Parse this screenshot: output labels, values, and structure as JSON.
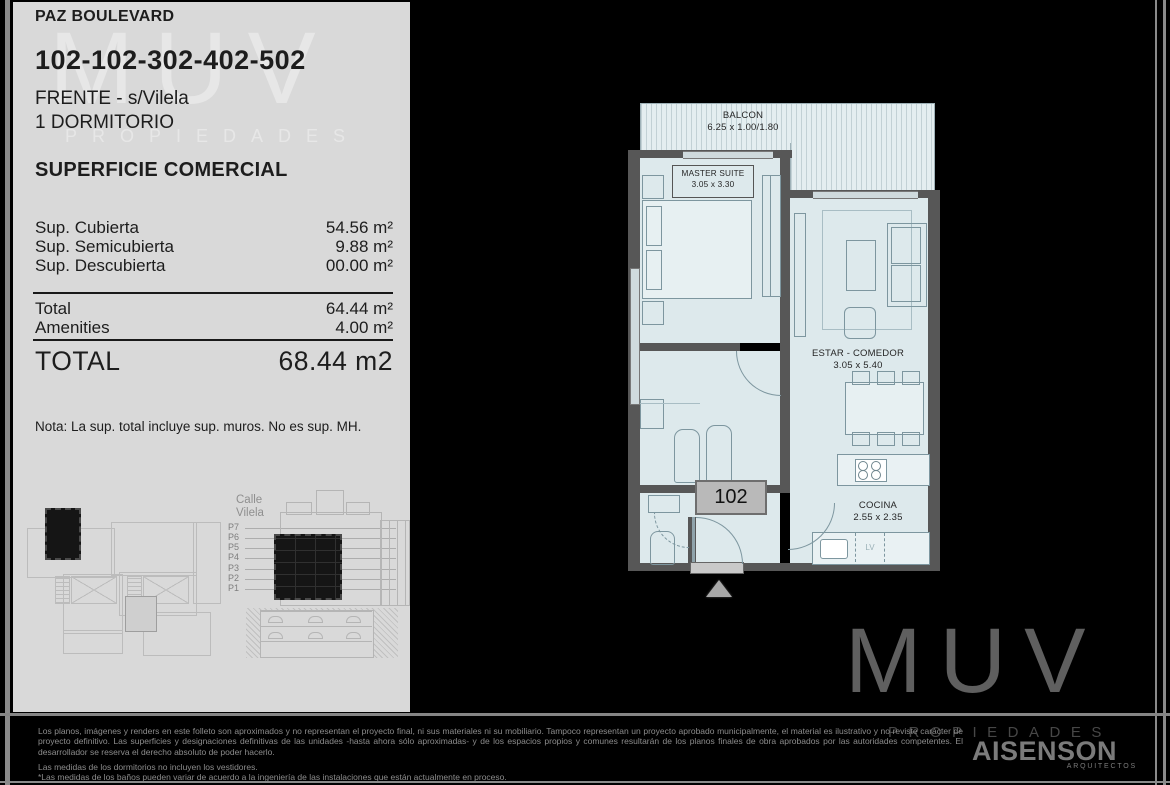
{
  "colors": {
    "panel_bg": "#d9d9d9",
    "plan_room_fill": "#dde9ec",
    "plan_wall": "#575757",
    "background": "#000000",
    "unit_box_fill": "#b9b9b9"
  },
  "panel": {
    "project": "PAZ BOULEVARD",
    "units": "102-102-302-402-502",
    "front": "FRENTE - s/Vilela",
    "bedrooms": "1 DORMITORIO",
    "section_title": "SUPERFICIE COMERCIAL",
    "surface_rows": [
      {
        "label": "Sup. Cubierta",
        "value": "54.56 m²"
      },
      {
        "label": "Sup. Semicubierta",
        "value": "9.88 m²"
      },
      {
        "label": "Sup. Descubierta",
        "value": "00.00 m²"
      }
    ],
    "subtotal_rows": [
      {
        "label": "Total",
        "value": "64.44 m²"
      },
      {
        "label": "Amenities",
        "value": "4.00 m²"
      }
    ],
    "total_label": "TOTAL",
    "total_value": "68.44 m2",
    "note": "Nota: La sup. total  incluye sup. muros. No es sup. MH.",
    "watermark_line1": "MUV",
    "watermark_line2": "PROPIEDADES"
  },
  "elevation": {
    "street": "Calle Vilela",
    "floors": [
      "P7",
      "P6",
      "P5",
      "P4",
      "P3",
      "P2",
      "P1"
    ]
  },
  "floorplan": {
    "unit_number": "102",
    "balcon": {
      "name": "BALCON",
      "dims": "6.25 x 1.00/1.80"
    },
    "master": {
      "name": "MASTER SUITE",
      "dims": "3.05 x 3.30"
    },
    "estar": {
      "name": "ESTAR - COMEDOR",
      "dims": "3.05 x 5.40"
    },
    "cocina": {
      "name": "COCINA",
      "dims": "2.55 x 2.35"
    },
    "lv_label": "LV"
  },
  "branding": {
    "muv": "MUV",
    "muv_sub": "PROPIEDADES",
    "architect": "AISENSON",
    "architect_sub": "ARQUITECTOS"
  },
  "disclaimer": {
    "para1": "Los planos, imágenes y renders en este folleto son aproximados y no representan el proyecto final, ni sus materiales ni su mobiliario. Tampoco representan un proyecto aprobado municipalmente, el material es ilustrativo y no reviste carácter de proyecto definitivo. Las superficies y designaciones definitivas de las unidades -hasta ahora sólo aproximadas- y de los espacios propios y comunes resultarán de los planos finales de obra aprobados por las autoridades competentes. El desarrollador se reserva el derecho absoluto de poder hacerlo.",
    "line_dorm": "Las medidas de los dormitorios no incluyen los vestidores.",
    "line_banos": "*Las medidas de los baños pueden variar de acuerdo a la ingeniería de las instalaciones que están actualmente en proceso."
  }
}
